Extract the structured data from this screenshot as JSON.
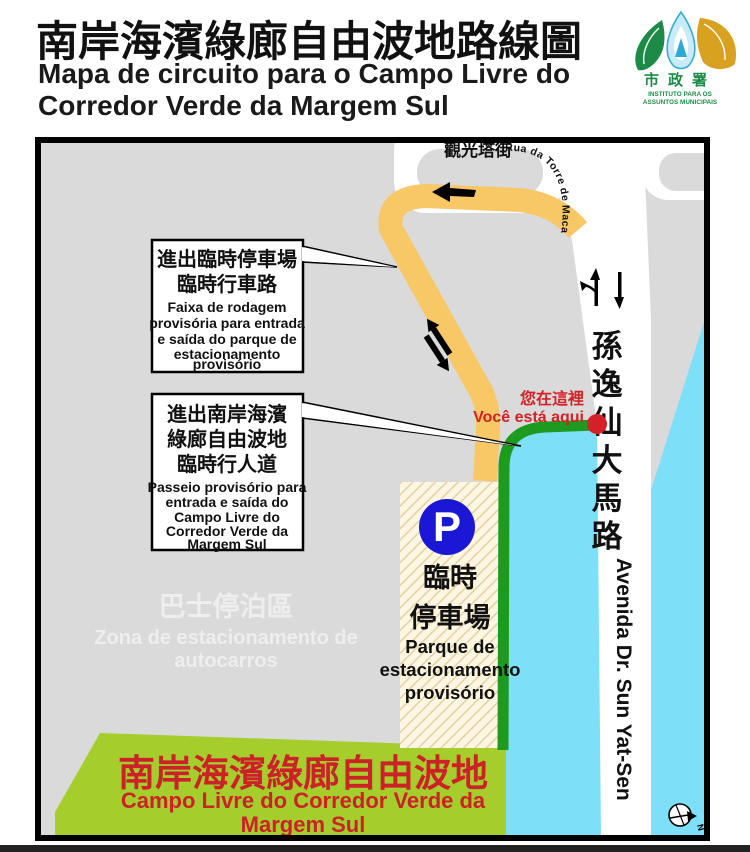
{
  "header": {
    "title": "南岸海濱綠廊自由波地路線圖",
    "subtitle_lines": [
      "Mapa de circuito para o Campo Livre do",
      "Corredor Verde da Margem Sul"
    ],
    "logo": {
      "cjk": "市政署",
      "latin_lines": [
        "INSTITUTO PARA OS",
        "ASSUNTOS MUNICIPAIS"
      ]
    }
  },
  "map": {
    "street_top": {
      "cjk": "觀光塔街",
      "latin": "Rua da Torre de Macau"
    },
    "avenue": {
      "cjk_chars": [
        "孫",
        "逸",
        "仙",
        "大",
        "馬",
        "路"
      ],
      "latin": "Avenida Dr. Sun Yat-Sen"
    },
    "you_are_here": {
      "cjk": "您在這裡",
      "latin": "Você está aqui"
    },
    "callout_car": {
      "cjk_lines": [
        "進出臨時停車場",
        "臨時行車路"
      ],
      "pt_lines": [
        "Faixa de rodagem",
        "provisória para entrada",
        "e saída do parque de",
        "estacionamento",
        "provisório"
      ]
    },
    "callout_ped": {
      "cjk_lines": [
        "進出南岸海濱",
        "綠廊自由波地",
        "臨時行人道"
      ],
      "pt_lines": [
        "Passeio provisório para",
        "entrada e saída do",
        "Campo Livre do",
        "Corredor Verde da",
        "Margem Sul"
      ]
    },
    "parking": {
      "symbol": "P",
      "cjk_lines": [
        "臨時",
        "停車場"
      ],
      "pt_lines": [
        "Parque de",
        "estacionamento",
        "provisório"
      ]
    },
    "green_zone": {
      "cjk": "南岸海濱綠廊自由波地",
      "pt_lines": [
        "Campo Livre do Corredor Verde da",
        "Margem Sul"
      ]
    },
    "watermark": {
      "cjk": "巴士停泊區",
      "pt_lines": [
        "Zona de estacionamento de",
        "autocarros"
      ]
    },
    "compass_n": "N"
  },
  "colors": {
    "car_route": "#F8C766",
    "ped_route": "#1E9B1E",
    "water": "#7DDFF8",
    "field_green": "#A5CE2D",
    "marker_red": "#D32127",
    "parking_blue": "#1A17D5",
    "land_gray": "#DADADA"
  }
}
